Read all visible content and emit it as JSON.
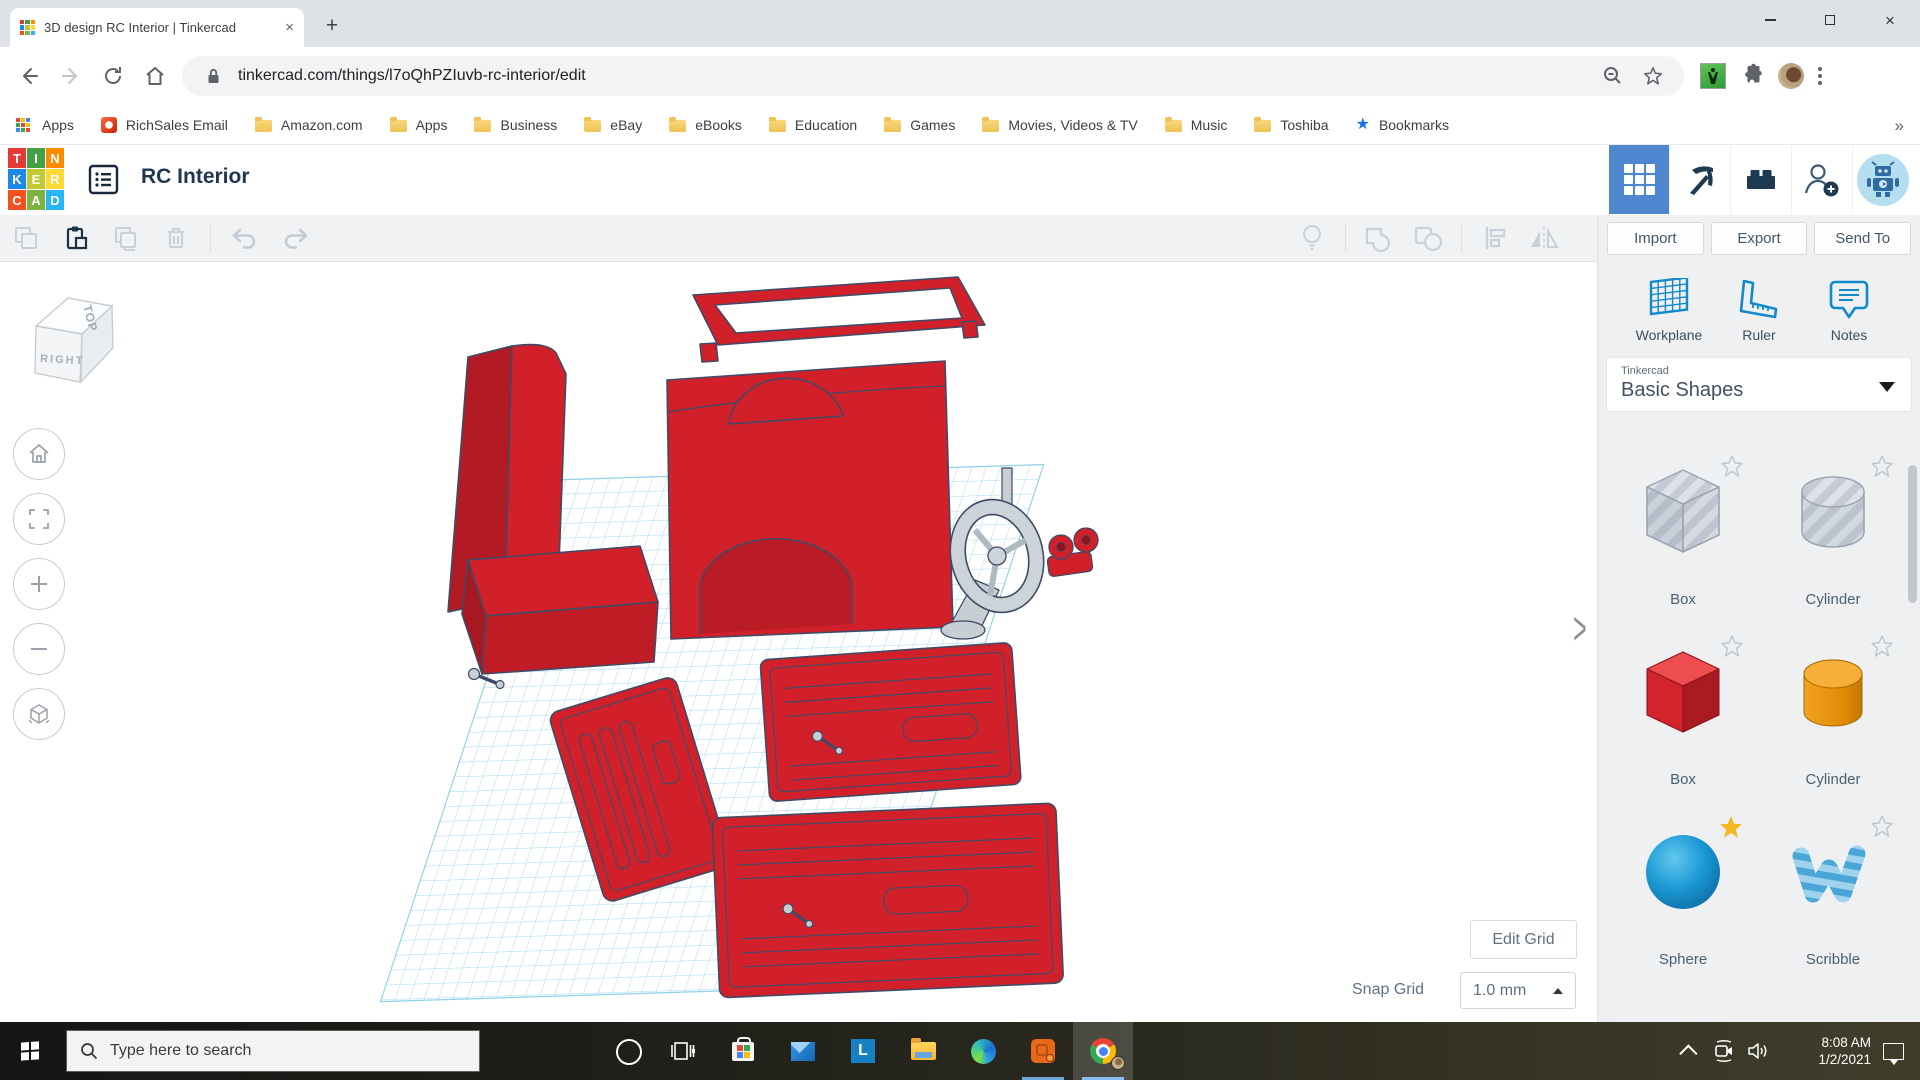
{
  "browser": {
    "tab": {
      "title": "3D design RC Interior | Tinkercad"
    },
    "url": "tinkercad.com/things/l7oQhPZIuvb-rc-interior/edit",
    "nav_icons": [
      "back-arrow",
      "forward-arrow",
      "reload",
      "home"
    ],
    "address_icons": [
      "lock",
      "zoom-out",
      "bookmark-star",
      "lindy-extension",
      "extensions-puzzle",
      "profile-avatar",
      "menu-kebab"
    ],
    "window_icons": [
      "minimize",
      "maximize",
      "close"
    ],
    "bookmarks": [
      {
        "label": "Apps",
        "icon": "grid"
      },
      {
        "label": "RichSales Email",
        "icon": "office"
      },
      {
        "label": "Amazon.com",
        "icon": "folder"
      },
      {
        "label": "Apps",
        "icon": "folder"
      },
      {
        "label": "Business",
        "icon": "folder"
      },
      {
        "label": "eBay",
        "icon": "folder"
      },
      {
        "label": "eBooks",
        "icon": "folder"
      },
      {
        "label": "Education",
        "icon": "folder"
      },
      {
        "label": "Games",
        "icon": "folder"
      },
      {
        "label": "Movies, Videos & TV",
        "icon": "folder"
      },
      {
        "label": "Music",
        "icon": "folder"
      },
      {
        "label": "Toshiba",
        "icon": "folder"
      },
      {
        "label": "Bookmarks",
        "icon": "star"
      }
    ],
    "overflow_chevron": "»"
  },
  "app": {
    "title": "RC Interior",
    "header_icons": [
      "tinkercad-logo",
      "properties-list",
      "dashboard-grid",
      "minecraft-pickaxe",
      "lego-brick",
      "invite-person",
      "robot-avatar"
    ],
    "edit_toolbar_icons": [
      "copy",
      "paste",
      "duplicate",
      "delete",
      "undo",
      "redo"
    ],
    "adjust_toolbar_icons": [
      "show-all-lightbulb",
      "group",
      "ungroup",
      "align",
      "mirror"
    ],
    "actions": {
      "import": "Import",
      "export": "Export",
      "send_to": "Send To"
    },
    "panel_tools": [
      {
        "label": "Workplane",
        "icon": "workplane-grid"
      },
      {
        "label": "Ruler",
        "icon": "ruler"
      },
      {
        "label": "Notes",
        "icon": "notes-bubble"
      }
    ],
    "library": {
      "brand": "Tinkercad",
      "name": "Basic Shapes"
    },
    "shapes": [
      {
        "label": "Box",
        "variant": "hole-gray-striped",
        "starred": false
      },
      {
        "label": "Cylinder",
        "variant": "hole-gray-striped",
        "starred": false
      },
      {
        "label": "Box",
        "variant": "solid-red",
        "starred": false
      },
      {
        "label": "Cylinder",
        "variant": "solid-orange",
        "starred": false
      },
      {
        "label": "Sphere",
        "variant": "solid-blue",
        "starred": true
      },
      {
        "label": "Scribble",
        "variant": "blue-striped",
        "starred": false
      }
    ],
    "view_cube": {
      "top": "TOP",
      "front": "RIGHT"
    },
    "canvas_controls": [
      "home-view",
      "fit-view",
      "zoom-in",
      "zoom-out",
      "perspective-toggle",
      "collapse-panel-chevron"
    ],
    "grid": {
      "edit_button": "Edit Grid",
      "snap_label": "Snap Grid",
      "snap_value": "1.0 mm"
    },
    "colors": {
      "accent_blue": "#4e86d0",
      "tool_blue": "#1389cc",
      "shape_red": "#d2202a",
      "workplane_blue": "#aedcf1"
    }
  },
  "taskbar": {
    "search_placeholder": "Type here to search",
    "icons": [
      "start",
      "cortana",
      "task-view",
      "store",
      "mail",
      "l-app",
      "file-explorer",
      "edge",
      "orange-app",
      "chrome"
    ],
    "tray_icons": [
      "tray-chevron",
      "meet-now-camera",
      "volume",
      "action-center"
    ],
    "clock": {
      "time": "8:08 AM",
      "date": "1/2/2021"
    }
  }
}
